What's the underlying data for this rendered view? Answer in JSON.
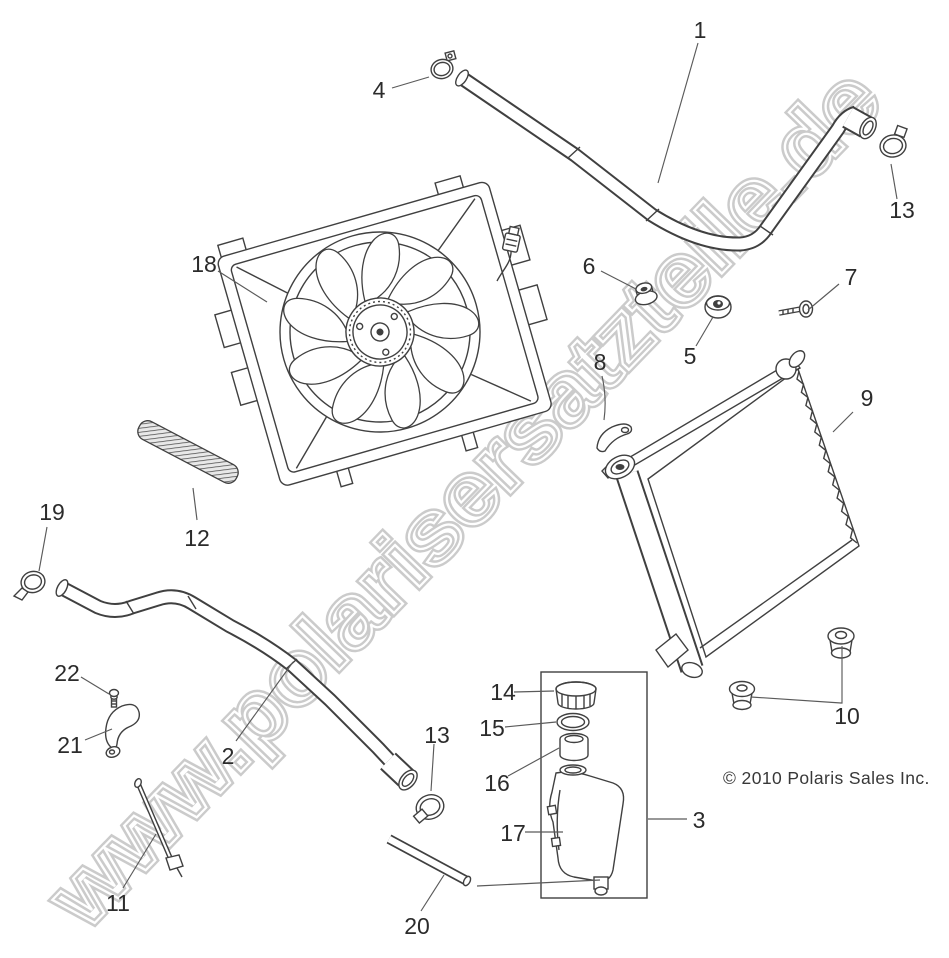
{
  "watermark": {
    "text": "www.polarisersatzteile.de"
  },
  "copyright": {
    "text": "© 2010 Polaris Sales Inc."
  },
  "callouts": {
    "c1": "1",
    "c2": "2",
    "c3": "3",
    "c4": "4",
    "c5": "5",
    "c6": "6",
    "c7": "7",
    "c8": "8",
    "c9": "9",
    "c10": "10",
    "c11": "11",
    "c12": "12",
    "c13_top": "13",
    "c13_mid": "13",
    "c14": "14",
    "c15": "15",
    "c16": "16",
    "c17": "17",
    "c18": "18",
    "c19": "19",
    "c20": "20",
    "c21": "21",
    "c22": "22"
  },
  "colors": {
    "line": "#404040",
    "watermark": "#cbcbcb",
    "background": "#ffffff"
  }
}
